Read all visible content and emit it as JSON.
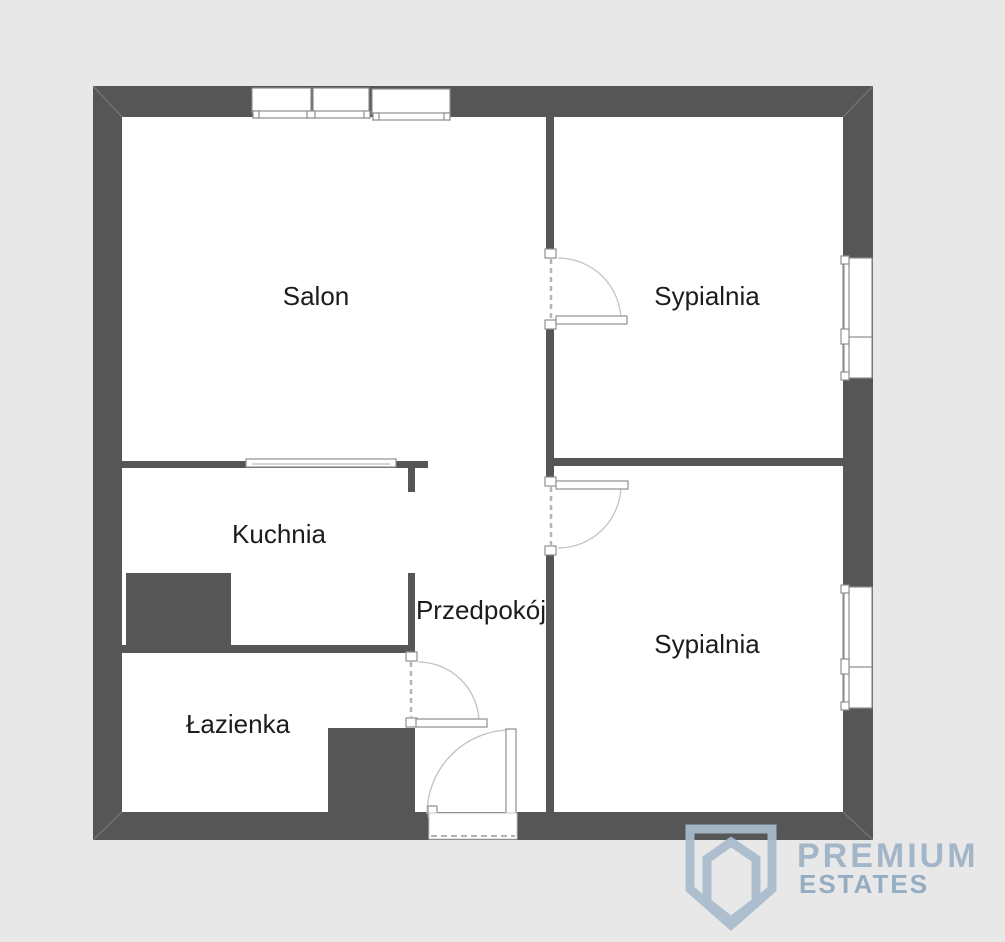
{
  "plan": {
    "rooms": [
      {
        "id": "salon",
        "label": "Salon"
      },
      {
        "id": "sypialnia-1",
        "label": "Sypialnia"
      },
      {
        "id": "sypialnia-2",
        "label": "Sypialnia"
      },
      {
        "id": "kuchnia",
        "label": "Kuchnia"
      },
      {
        "id": "przedpokoj",
        "label": "Przedpokój"
      },
      {
        "id": "lazienka",
        "label": "Łazienka"
      }
    ]
  },
  "logo": {
    "icon": "shield-gem-icon",
    "line1": "PREMIUM",
    "line2": "ESTATES"
  },
  "colors": {
    "background": "#e8e8e8",
    "floor": "#ffffff",
    "wall": "#565656",
    "label": "#1c1c1c",
    "fixture_fill": "#ffffff",
    "fixture_outline": "#8f8f8f",
    "door_arc": "#c2c2c2",
    "jamb_dash": "#b5b5b5",
    "miter_line": "#9a9a9a",
    "logo_shield": "#a9bccd",
    "logo_premium": "#9db2c6",
    "logo_estates": "#8da8c0"
  }
}
